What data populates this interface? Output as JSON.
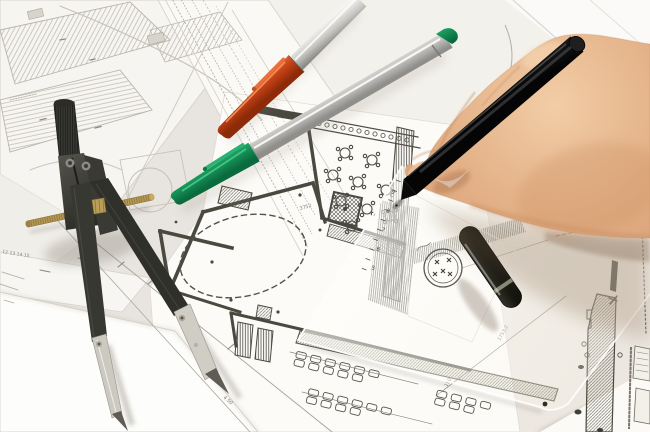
{
  "scene": {
    "description": "Close-up photo of a hand drawing with a black pen on overlapping architectural floor plans; a drafting compass, an orange marker, a green marker, a translucent triangle ruler and a black pen cap lie on the plans",
    "background_color": "#e8e5e0",
    "paper_color": "#f7f6f2",
    "ink_color": "#4a493f",
    "objects": [
      {
        "name": "drafting-compass",
        "color": "#35352f",
        "metal_color": "#ccc9c1",
        "screw_rod_color": "#b59a55"
      },
      {
        "name": "orange-marker-pen",
        "cap_color": "#c84318",
        "barrel_color": "#d9d8d4"
      },
      {
        "name": "green-marker-pen",
        "cap_color": "#1a9a5e",
        "barrel_color": "#d9d8d4",
        "end_plug_color": "#1a9a5e"
      },
      {
        "name": "black-drawing-pen",
        "color": "#161616"
      },
      {
        "name": "pen-cap",
        "color": "#191913",
        "ring_color": "#9aa08b"
      },
      {
        "name": "triangle-ruler",
        "color": "rgba(255,255,250,0.5)",
        "stamp_color": "#55534a"
      },
      {
        "name": "hand",
        "skin_color": "#e2af89"
      },
      {
        "name": "floor-plan-sheets",
        "features": "restaurant room with round tables, dashed circle room, parking rows with cars, hatched walls, dimension lines"
      }
    ]
  },
  "plan": {
    "margin_numbers": "12 13 14 15",
    "dimension_labels": [
      {
        "text": "585"
      },
      {
        "text": "4.50"
      },
      {
        "text": "1753.2"
      },
      {
        "text": "150"
      },
      {
        "text": "3752"
      }
    ]
  },
  "ruler": {
    "scale_numbers": [
      "9",
      "8",
      "7",
      "6",
      "5"
    ]
  }
}
